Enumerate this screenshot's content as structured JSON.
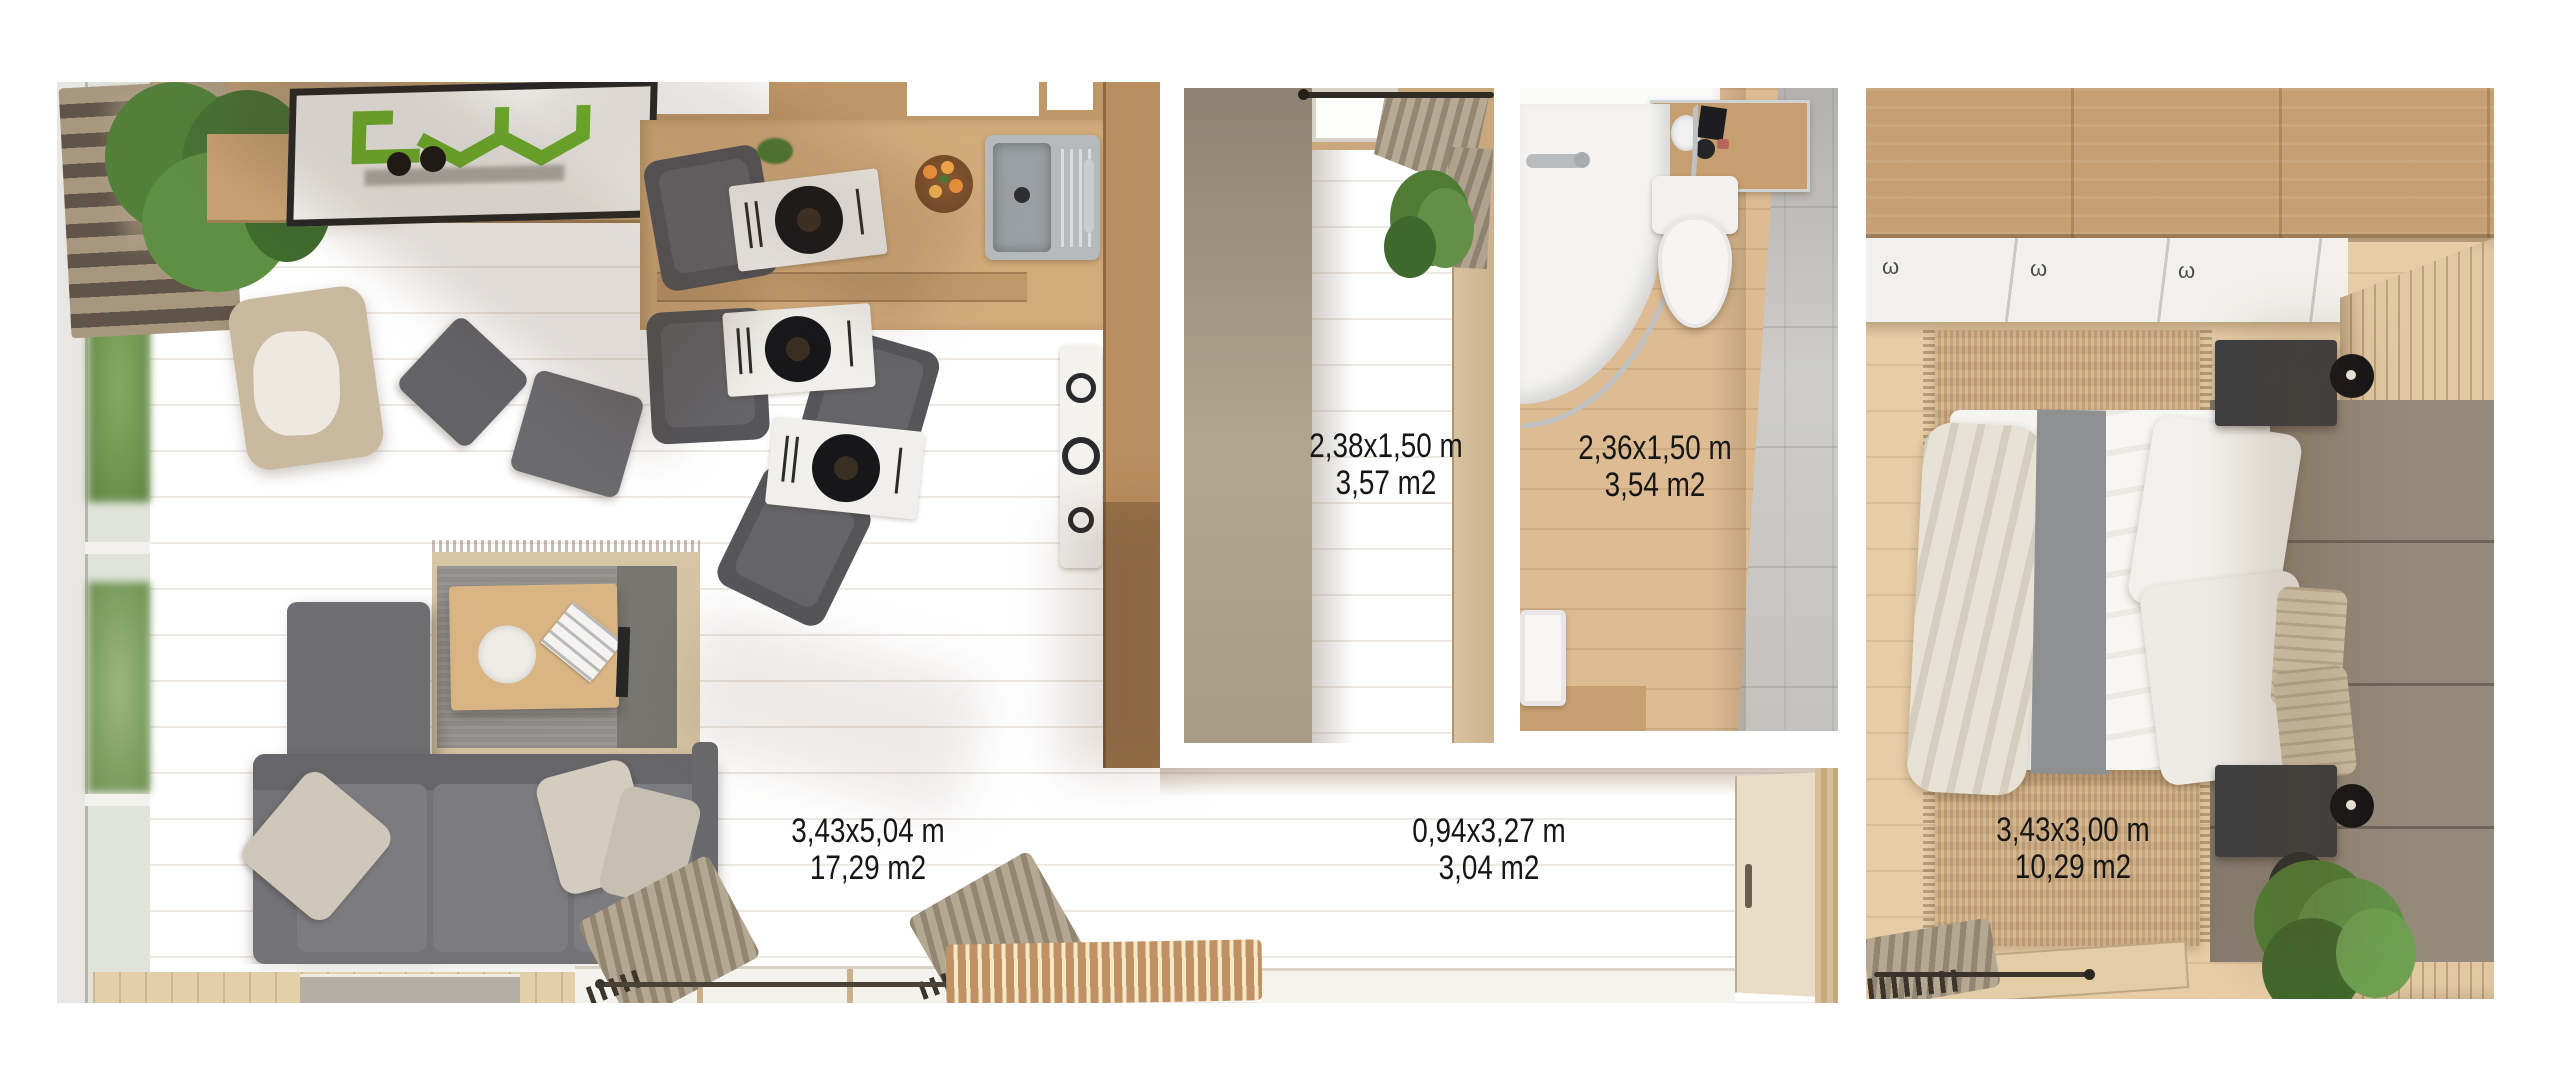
{
  "rooms": {
    "living": {
      "dimensions": "3,43x5,04 m",
      "area": "17,29 m2"
    },
    "hallway": {
      "dimensions": "2,38x1,50 m",
      "area": "3,57 m2"
    },
    "bathroom": {
      "dimensions": "2,36x1,50 m",
      "area": "3,54 m2"
    },
    "corridor": {
      "dimensions": "0,94x3,27 m",
      "area": "3,04 m2"
    },
    "bedroom": {
      "dimensions": "3,43x3,00 m",
      "area": "10,29 m2"
    }
  },
  "colors": {
    "background": "#ffffff",
    "label_text": "#161616",
    "logo_green": "#6cb32c",
    "floor_wood": "#e6cba4",
    "wall_wood": "#c19467",
    "sofa_grey": "#737377",
    "tile_grey": "#c4c2be",
    "headboard_taupe": "#958a7c",
    "plant_green": "#517e37"
  },
  "icons": {
    "doormat_logo": "green geometric house logo",
    "ceiling_hook": "ω"
  },
  "hooks": {
    "glyph": "ω"
  }
}
